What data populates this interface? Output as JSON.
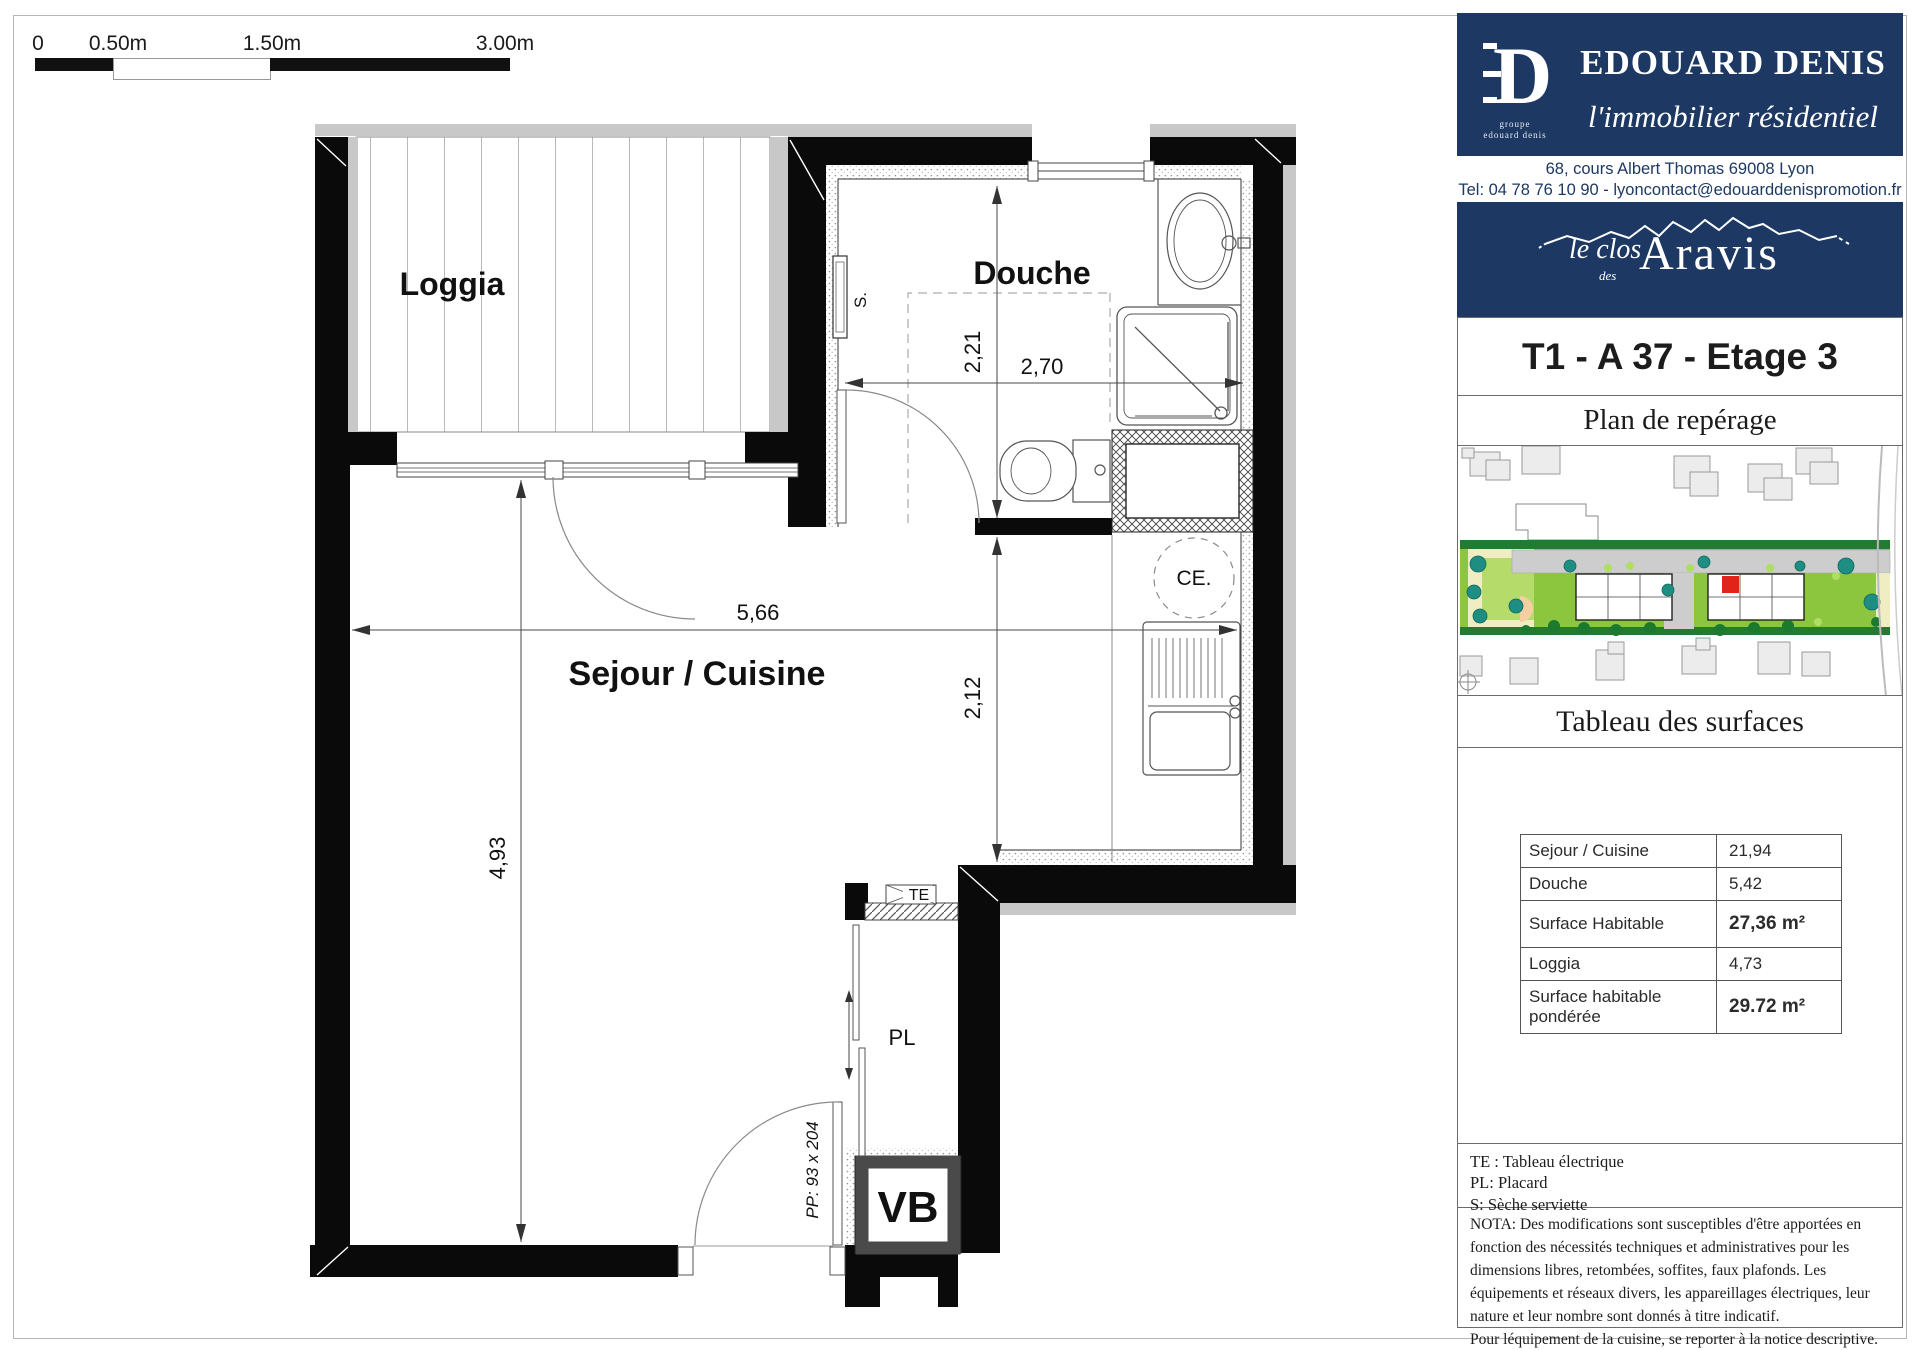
{
  "scale_bar": {
    "zero": "0",
    "half": "0.50m",
    "one_half": "1.50m",
    "three": "3.00m"
  },
  "floor_plan": {
    "rooms": {
      "loggia": "Loggia",
      "douche": "Douche",
      "sejour": "Sejour / Cuisine"
    },
    "dims": {
      "d221": "2,21",
      "d270": "2,70",
      "d566": "5,66",
      "d212": "2,12",
      "d493": "4,93"
    },
    "marks": {
      "towel_dryer": "S.",
      "water_heater": "CE.",
      "electrical_panel": "TE",
      "closet": "PL",
      "vb_shaft": "VB",
      "entry_door": "PP: 93 x 204"
    }
  },
  "sidebar": {
    "brand": {
      "monogram": "D",
      "name": "EDOUARD DENIS",
      "tagline": "l'immobilier résidentiel",
      "group_line1": "groupe",
      "group_line2": "edouard denis",
      "address": "68, cours Albert Thomas 69008 Lyon",
      "contact": "Tel: 04 78 76 10 90 - lyoncontact@edouarddenispromotion.fr"
    },
    "project": {
      "prefix": "le clos",
      "middle": "des",
      "name": "Aravis"
    },
    "unit_title": "T1 - A 37 - Etage 3",
    "map_title": "Plan de repérage",
    "surfaces_title": "Tableau des surfaces",
    "surfaces_table": {
      "rows": [
        {
          "label": "Sejour / Cuisine",
          "value": "21,94",
          "bold": false
        },
        {
          "label": "Douche",
          "value": "5,42",
          "bold": false
        },
        {
          "label": "Surface Habitable",
          "value": "27,36 m²",
          "bold": true
        },
        {
          "label": "Loggia",
          "value": "4,73",
          "bold": false
        },
        {
          "label": "Surface habitable pondérée",
          "value": "29.72 m²",
          "bold": true
        }
      ]
    },
    "legend": [
      "TE : Tableau électrique",
      "PL: Placard",
      "S: Sèche serviette"
    ],
    "nota": [
      "NOTA: Des modifications sont susceptibles d'être apportées en fonction des nécessités techniques et administratives pour les dimensions libres, retombées, soffites, faux plafonds. Les équipements et réseaux divers, les appareillages électriques, leur nature et leur nombre sont donnés à titre indicatif.",
      "Pour léquipement de la cuisine, se reporter à la notice descriptive.",
      "La végétation n'est pas contractuelle."
    ],
    "colors": {
      "navy": "#1d3963",
      "unit_marker_red": "#e2231a",
      "site_green": "#8CC63F"
    }
  }
}
